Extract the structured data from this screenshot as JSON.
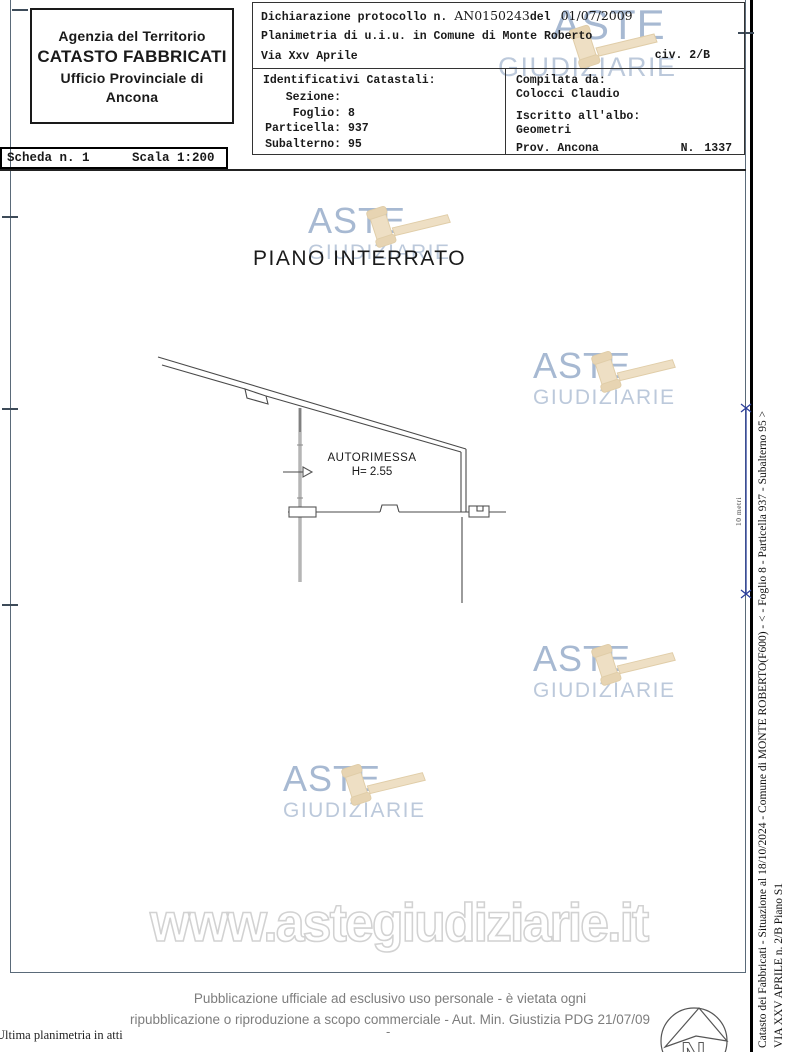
{
  "header": {
    "agency": {
      "line1": "Agenzia del Territorio",
      "line2": "CATASTO FABBRICATI",
      "line3": "Ufficio Provinciale di",
      "line4": "Ancona"
    },
    "scheda": {
      "label": "Scheda n. 1",
      "scale": "Scala 1:200"
    },
    "declaration": {
      "line1_prefix": "Dichiarazione protocollo n. ",
      "protocol": "AN0150243",
      "line1_mid": "del",
      "date": "01/07/2009",
      "line2": "Planimetria di u.i.u. in Comune di Monte Roberto",
      "line3": "Via Xxv Aprile",
      "civ": "civ. 2/B"
    },
    "identifiers": {
      "title": "Identificativi Catastali:",
      "rows": [
        {
          "label": "Sezione:",
          "value": ""
        },
        {
          "label": "Foglio:",
          "value": "8"
        },
        {
          "label": "Particella:",
          "value": "937"
        },
        {
          "label": "Subalterno:",
          "value": "95"
        }
      ]
    },
    "compiler": {
      "label1": "Compilata da:",
      "name": "Colocci Claudio",
      "label2": "Iscritto all'albo:",
      "albo": "Geometri",
      "prov": "Prov. Ancona",
      "n_label": "N.",
      "n_value": "1337"
    }
  },
  "plan": {
    "floor_title": "PIANO INTERRATO",
    "room_label": "AUTORIMESSA",
    "room_height": "H= 2.55",
    "scalebar_label": "10 metri"
  },
  "watermark": {
    "aste": "ASTE",
    "giudiziarie": "GIUDIZIARIE",
    "url": "www.astegiudiziarie.it"
  },
  "sidebar": {
    "line1": "Catasto dei Fabbricati - Situazione al 18/10/2024 - Comune di MONTE ROBERTO(F600) - < - Foglio 8 - Particella 937 - Subalterno 95 >",
    "line2": "VIA XXV APRILE n. 2/B Piano S1"
  },
  "footer": {
    "disclaimer1": "Pubblicazione ufficiale ad esclusivo uso personale - è vietata ogni",
    "disclaimer2": "ripubblicazione o riproduzione a scopo commerciale - Aut. Min. Giustizia PDG 21/07/09",
    "dash": "-",
    "note": "Ultima planimetria in atti"
  },
  "colors": {
    "watermark_blue": "#a7b9d2",
    "watermark_blue_light": "#bcc9db",
    "gavel_tan": "#eedfc4",
    "scalebar_blue": "#2b3f9b",
    "disclaimer_gray": "#7d7d7d"
  }
}
